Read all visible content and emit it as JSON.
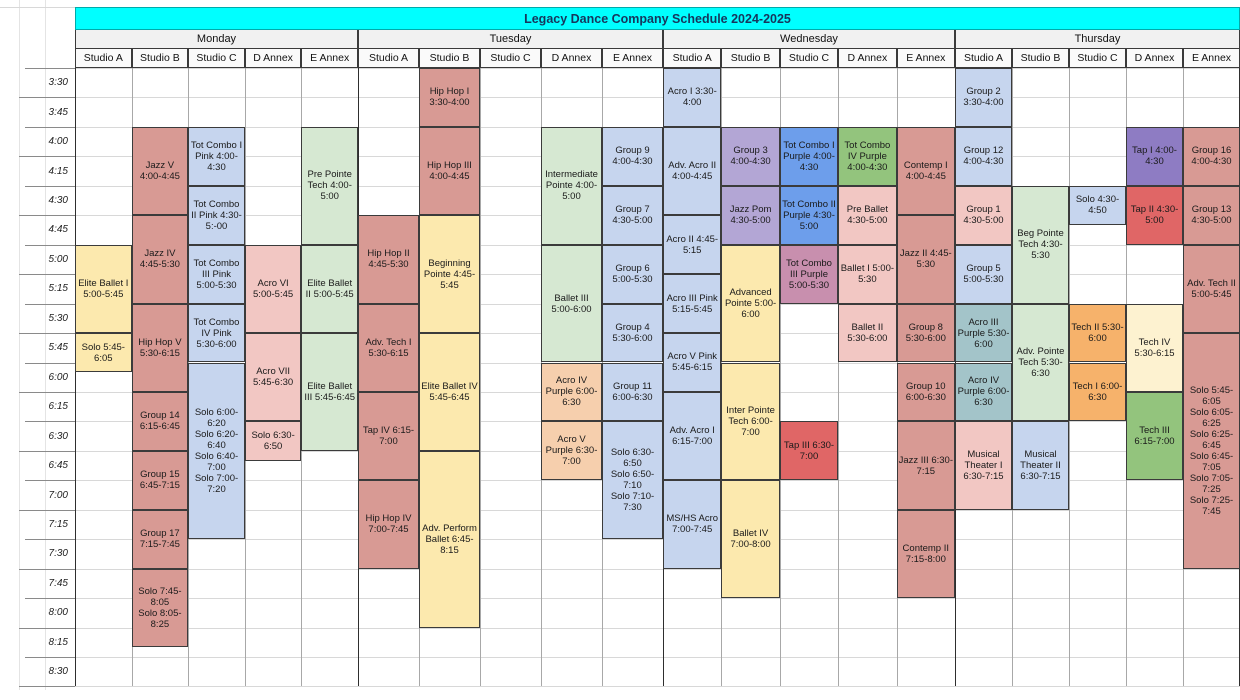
{
  "title": "Legacy Dance Company Schedule 2024-2025",
  "days": [
    {
      "name": "Monday",
      "studios": [
        "Studio A",
        "Studio B",
        "Studio C",
        "D Annex",
        "E Annex"
      ]
    },
    {
      "name": "Tuesday",
      "studios": [
        "Studio A",
        "Studio B",
        "Studio C",
        "D Annex",
        "E Annex"
      ]
    },
    {
      "name": "Wednesday",
      "studios": [
        "Studio A",
        "Studio B",
        "Studio C",
        "D Annex",
        "E Annex"
      ]
    },
    {
      "name": "Thursday",
      "studios": [
        "Studio A",
        "Studio B",
        "Studio C",
        "D Annex",
        "E Annex"
      ]
    }
  ],
  "times": [
    "3:30",
    "3:45",
    "4:00",
    "4:15",
    "4:30",
    "4:45",
    "5:00",
    "5:15",
    "5:30",
    "5:45",
    "6:00",
    "6:15",
    "6:30",
    "6:45",
    "7:00",
    "7:15",
    "7:30",
    "7:45",
    "8:00",
    "8:15",
    "8:30"
  ],
  "colors": {
    "title_bg": "#00ffff",
    "salmon": "#d89a94",
    "pink": "#f2c7c3",
    "periwinkle": "#c6d5ee",
    "yellow": "#fce9ae",
    "cream": "#fdf2d0",
    "green": "#d6e8d2",
    "medgreen": "#93c47d",
    "lavender": "#b3a6d5",
    "purple": "#8e7cc3",
    "red": "#e06666",
    "blue": "#6d9eeb",
    "mauve": "#c88fae",
    "teal": "#a3c4c9",
    "orange": "#f6b26b",
    "peach": "#f6cfad"
  },
  "classes": [
    {
      "day": 0,
      "col": 0,
      "start": "5:00",
      "end": "5:45",
      "color": "yellow",
      "label": "Elite Ballet I 5:00-5:45"
    },
    {
      "day": 0,
      "col": 0,
      "start": "5:45",
      "end": "6:05",
      "color": "yellow",
      "label": "Solo 5:45-6:05"
    },
    {
      "day": 0,
      "col": 1,
      "start": "4:00",
      "end": "4:45",
      "color": "salmon",
      "label": "Jazz V 4:00-4:45"
    },
    {
      "day": 0,
      "col": 1,
      "start": "4:45",
      "end": "5:30",
      "color": "salmon",
      "label": "Jazz IV 4:45-5:30"
    },
    {
      "day": 0,
      "col": 1,
      "start": "5:30",
      "end": "6:15",
      "color": "salmon",
      "label": "Hip Hop V 5:30-6:15"
    },
    {
      "day": 0,
      "col": 1,
      "start": "6:15",
      "end": "6:45",
      "color": "salmon",
      "label": "Group 14 6:15-6:45"
    },
    {
      "day": 0,
      "col": 1,
      "start": "6:45",
      "end": "7:15",
      "color": "salmon",
      "label": "Group 15 6:45-7:15"
    },
    {
      "day": 0,
      "col": 1,
      "start": "7:15",
      "end": "7:45",
      "color": "salmon",
      "label": "Group 17 7:15-7:45"
    },
    {
      "day": 0,
      "col": 1,
      "start": "7:45",
      "end": "8:25",
      "color": "salmon",
      "label": "Solo 7:45-8:05\nSolo 8:05-8:25"
    },
    {
      "day": 0,
      "col": 2,
      "start": "4:00",
      "end": "4:30",
      "color": "periwinkle",
      "label": "Tot Combo I Pink 4:00-4:30"
    },
    {
      "day": 0,
      "col": 2,
      "start": "4:30",
      "end": "5:00",
      "color": "periwinkle",
      "label": "Tot Combo II Pink 4:30-5:-00"
    },
    {
      "day": 0,
      "col": 2,
      "start": "5:00",
      "end": "5:30",
      "color": "periwinkle",
      "label": "Tot Combo III Pink 5:00-5:30"
    },
    {
      "day": 0,
      "col": 2,
      "start": "5:30",
      "end": "6:00",
      "color": "periwinkle",
      "label": "Tot Combo IV Pink 5:30-6:00"
    },
    {
      "day": 0,
      "col": 2,
      "start": "6:00",
      "end": "7:30",
      "color": "periwinkle",
      "label": "Solo 6:00-6:20\nSolo 6:20-6:40\nSolo 6:40-7:00\nSolo 7:00-7:20"
    },
    {
      "day": 0,
      "col": 3,
      "start": "5:00",
      "end": "5:45",
      "color": "pink",
      "label": "Acro VI 5:00-5:45"
    },
    {
      "day": 0,
      "col": 3,
      "start": "5:45",
      "end": "6:30",
      "color": "pink",
      "label": "Acro VII 5:45-6:30"
    },
    {
      "day": 0,
      "col": 3,
      "start": "6:30",
      "end": "6:50",
      "color": "pink",
      "label": "Solo 6:30-6:50"
    },
    {
      "day": 0,
      "col": 4,
      "start": "4:00",
      "end": "5:00",
      "color": "green",
      "label": "Pre Pointe Tech 4:00-5:00"
    },
    {
      "day": 0,
      "col": 4,
      "start": "5:00",
      "end": "5:45",
      "color": "green",
      "label": "Elite Ballet II 5:00-5:45"
    },
    {
      "day": 0,
      "col": 4,
      "start": "5:45",
      "end": "6:45",
      "color": "green",
      "label": "Elite Ballet III 5:45-6:45"
    },
    {
      "day": 1,
      "col": 0,
      "start": "4:45",
      "end": "5:30",
      "color": "salmon",
      "label": "Hip Hop II 4:45-5:30"
    },
    {
      "day": 1,
      "col": 0,
      "start": "5:30",
      "end": "6:15",
      "color": "salmon",
      "label": "Adv. Tech I 5:30-6:15"
    },
    {
      "day": 1,
      "col": 0,
      "start": "6:15",
      "end": "7:00",
      "color": "salmon",
      "label": "Tap IV 6:15-7:00"
    },
    {
      "day": 1,
      "col": 0,
      "start": "7:00",
      "end": "7:45",
      "color": "salmon",
      "label": "Hip Hop IV 7:00-7:45"
    },
    {
      "day": 1,
      "col": 1,
      "start": "3:30",
      "end": "4:00",
      "color": "salmon",
      "label": "Hip Hop I 3:30-4:00"
    },
    {
      "day": 1,
      "col": 1,
      "start": "4:00",
      "end": "4:45",
      "color": "salmon",
      "label": "Hip Hop III 4:00-4:45"
    },
    {
      "day": 1,
      "col": 1,
      "start": "4:45",
      "end": "5:45",
      "color": "yellow",
      "label": "Beginning Pointe 4:45-5:45"
    },
    {
      "day": 1,
      "col": 1,
      "start": "5:45",
      "end": "6:45",
      "color": "yellow",
      "label": "Elite Ballet IV 5:45-6:45"
    },
    {
      "day": 1,
      "col": 1,
      "start": "6:45",
      "end": "8:15",
      "color": "yellow",
      "label": "Adv. Perform Ballet 6:45-8:15"
    },
    {
      "day": 1,
      "col": 3,
      "start": "4:00",
      "end": "5:00",
      "color": "green",
      "label": "Intermediate Pointe 4:00-5:00"
    },
    {
      "day": 1,
      "col": 3,
      "start": "5:00",
      "end": "6:00",
      "color": "green",
      "label": "Ballet III 5:00-6:00"
    },
    {
      "day": 1,
      "col": 3,
      "start": "6:00",
      "end": "6:30",
      "color": "peach",
      "label": "Acro IV Purple 6:00-6:30"
    },
    {
      "day": 1,
      "col": 3,
      "start": "6:30",
      "end": "7:00",
      "color": "peach",
      "label": "Acro V Purple 6:30-7:00"
    },
    {
      "day": 1,
      "col": 4,
      "start": "4:00",
      "end": "4:30",
      "color": "periwinkle",
      "label": "Group 9 4:00-4:30"
    },
    {
      "day": 1,
      "col": 4,
      "start": "4:30",
      "end": "5:00",
      "color": "periwinkle",
      "label": "Group 7 4:30-5:00"
    },
    {
      "day": 1,
      "col": 4,
      "start": "5:00",
      "end": "5:30",
      "color": "periwinkle",
      "label": "Group 6 5:00-5:30"
    },
    {
      "day": 1,
      "col": 4,
      "start": "5:30",
      "end": "6:00",
      "color": "periwinkle",
      "label": "Group 4 5:30-6:00"
    },
    {
      "day": 1,
      "col": 4,
      "start": "6:00",
      "end": "6:30",
      "color": "periwinkle",
      "label": "Group 11 6:00-6:30"
    },
    {
      "day": 1,
      "col": 4,
      "start": "6:30",
      "end": "7:30",
      "color": "periwinkle",
      "label": "Solo 6:30-6:50\nSolo 6:50-7:10\nSolo 7:10-7:30"
    },
    {
      "day": 2,
      "col": 0,
      "start": "3:30",
      "end": "4:00",
      "color": "periwinkle",
      "label": "Acro I 3:30-4:00"
    },
    {
      "day": 2,
      "col": 0,
      "start": "4:00",
      "end": "4:45",
      "color": "periwinkle",
      "label": "Adv. Acro II 4:00-4:45"
    },
    {
      "day": 2,
      "col": 0,
      "start": "4:45",
      "end": "5:15",
      "color": "periwinkle",
      "label": "Acro II 4:45-5:15"
    },
    {
      "day": 2,
      "col": 0,
      "start": "5:15",
      "end": "5:45",
      "color": "periwinkle",
      "label": "Acro III Pink 5:15-5:45"
    },
    {
      "day": 2,
      "col": 0,
      "start": "5:45",
      "end": "6:15",
      "color": "periwinkle",
      "label": "Acro V Pink 5:45-6:15"
    },
    {
      "day": 2,
      "col": 0,
      "start": "6:15",
      "end": "7:00",
      "color": "periwinkle",
      "label": "Adv. Acro I 6:15-7:00"
    },
    {
      "day": 2,
      "col": 0,
      "start": "7:00",
      "end": "7:45",
      "color": "periwinkle",
      "label": "MS/HS Acro 7:00-7:45"
    },
    {
      "day": 2,
      "col": 1,
      "start": "4:00",
      "end": "4:30",
      "color": "lavender",
      "label": "Group 3 4:00-4:30"
    },
    {
      "day": 2,
      "col": 1,
      "start": "4:30",
      "end": "5:00",
      "color": "lavender",
      "label": "Jazz Pom 4:30-5:00"
    },
    {
      "day": 2,
      "col": 1,
      "start": "5:00",
      "end": "6:00",
      "color": "yellow",
      "label": "Advanced Pointe 5:00-6:00"
    },
    {
      "day": 2,
      "col": 1,
      "start": "6:00",
      "end": "7:00",
      "color": "yellow",
      "label": "Inter Pointe Tech 6:00-7:00"
    },
    {
      "day": 2,
      "col": 1,
      "start": "7:00",
      "end": "8:00",
      "color": "yellow",
      "label": "Ballet IV 7:00-8:00"
    },
    {
      "day": 2,
      "col": 2,
      "start": "4:00",
      "end": "4:30",
      "color": "blue",
      "label": "Tot Combo I Purple 4:00-4:30"
    },
    {
      "day": 2,
      "col": 2,
      "start": "4:30",
      "end": "5:00",
      "color": "blue",
      "label": "Tot Combo II Purple 4:30-5:00"
    },
    {
      "day": 2,
      "col": 2,
      "start": "5:00",
      "end": "5:30",
      "color": "mauve",
      "label": "Tot Combo III Purple 5:00-5:30"
    },
    {
      "day": 2,
      "col": 2,
      "start": "6:30",
      "end": "7:00",
      "color": "red",
      "label": "Tap III 6:30-7:00"
    },
    {
      "day": 2,
      "col": 3,
      "start": "4:00",
      "end": "4:30",
      "color": "medgreen",
      "label": "Tot Combo IV Purple 4:00-4:30"
    },
    {
      "day": 2,
      "col": 3,
      "start": "4:30",
      "end": "5:00",
      "color": "pink",
      "label": "Pre Ballet 4:30-5:00"
    },
    {
      "day": 2,
      "col": 3,
      "start": "5:00",
      "end": "5:30",
      "color": "pink",
      "label": "Ballet I 5:00-5:30"
    },
    {
      "day": 2,
      "col": 3,
      "start": "5:30",
      "end": "6:00",
      "color": "pink",
      "label": "Ballet II 5:30-6:00"
    },
    {
      "day": 2,
      "col": 4,
      "start": "4:00",
      "end": "4:45",
      "color": "salmon",
      "label": "Contemp I 4:00-4:45"
    },
    {
      "day": 2,
      "col": 4,
      "start": "4:45",
      "end": "5:30",
      "color": "salmon",
      "label": "Jazz II 4:45-5:30"
    },
    {
      "day": 2,
      "col": 4,
      "start": "5:30",
      "end": "6:00",
      "color": "salmon",
      "label": "Group 8 5:30-6:00"
    },
    {
      "day": 2,
      "col": 4,
      "start": "6:00",
      "end": "6:30",
      "color": "salmon",
      "label": "Group 10 6:00-6:30"
    },
    {
      "day": 2,
      "col": 4,
      "start": "6:30",
      "end": "7:15",
      "color": "salmon",
      "label": "Jazz III 6:30-7:15"
    },
    {
      "day": 2,
      "col": 4,
      "start": "7:15",
      "end": "8:00",
      "color": "salmon",
      "label": "Contemp II 7:15-8:00"
    },
    {
      "day": 3,
      "col": 0,
      "start": "3:30",
      "end": "4:00",
      "color": "periwinkle",
      "label": "Group 2 3:30-4:00"
    },
    {
      "day": 3,
      "col": 0,
      "start": "4:00",
      "end": "4:30",
      "color": "periwinkle",
      "label": "Group 12 4:00-4:30"
    },
    {
      "day": 3,
      "col": 0,
      "start": "4:30",
      "end": "5:00",
      "color": "pink",
      "label": "Group 1 4:30-5:00"
    },
    {
      "day": 3,
      "col": 0,
      "start": "5:00",
      "end": "5:30",
      "color": "periwinkle",
      "label": "Group 5 5:00-5:30"
    },
    {
      "day": 3,
      "col": 0,
      "start": "5:30",
      "end": "6:00",
      "color": "teal",
      "label": "Acro III Purple 5:30-6:00"
    },
    {
      "day": 3,
      "col": 0,
      "start": "6:00",
      "end": "6:30",
      "color": "teal",
      "label": "Acro IV Purple 6:00-6:30"
    },
    {
      "day": 3,
      "col": 0,
      "start": "6:30",
      "end": "7:15",
      "color": "pink",
      "label": "Musical Theater I 6:30-7:15"
    },
    {
      "day": 3,
      "col": 1,
      "start": "4:30",
      "end": "5:30",
      "color": "green",
      "label": "Beg Pointe Tech 4:30-5:30"
    },
    {
      "day": 3,
      "col": 1,
      "start": "5:30",
      "end": "6:30",
      "color": "green",
      "label": "Adv. Pointe Tech 5:30-6:30"
    },
    {
      "day": 3,
      "col": 1,
      "start": "6:30",
      "end": "7:15",
      "color": "periwinkle",
      "label": "Musical Theater II 6:30-7:15"
    },
    {
      "day": 3,
      "col": 2,
      "start": "4:30",
      "end": "4:50",
      "color": "periwinkle",
      "label": "Solo 4:30-4:50"
    },
    {
      "day": 3,
      "col": 2,
      "start": "5:30",
      "end": "6:00",
      "color": "orange",
      "label": "Tech II 5:30-6:00"
    },
    {
      "day": 3,
      "col": 2,
      "start": "6:00",
      "end": "6:30",
      "color": "orange",
      "label": "Tech I 6:00-6:30"
    },
    {
      "day": 3,
      "col": 3,
      "start": "4:00",
      "end": "4:30",
      "color": "purple",
      "label": "Tap I 4:00-4:30"
    },
    {
      "day": 3,
      "col": 3,
      "start": "4:30",
      "end": "5:00",
      "color": "red",
      "label": "Tap II 4:30-5:00"
    },
    {
      "day": 3,
      "col": 3,
      "start": "5:30",
      "end": "6:15",
      "color": "cream",
      "label": "Tech IV 5:30-6:15"
    },
    {
      "day": 3,
      "col": 3,
      "start": "6:15",
      "end": "7:00",
      "color": "medgreen",
      "label": "Tech III 6:15-7:00"
    },
    {
      "day": 3,
      "col": 4,
      "start": "4:00",
      "end": "4:30",
      "color": "salmon",
      "label": "Group 16 4:00-4:30"
    },
    {
      "day": 3,
      "col": 4,
      "start": "4:30",
      "end": "5:00",
      "color": "salmon",
      "label": "Group 13 4:30-5:00"
    },
    {
      "day": 3,
      "col": 4,
      "start": "5:00",
      "end": "5:45",
      "color": "salmon",
      "label": "Adv. Tech II 5:00-5:45"
    },
    {
      "day": 3,
      "col": 4,
      "start": "5:45",
      "end": "7:45",
      "color": "salmon",
      "label": "Solo 5:45-6:05\nSolo 6:05-6:25\nSolo 6:25-6:45\nSolo 6:45-7:05\nSolo 7:05-7:25\nSolo 7:25-7:45"
    }
  ]
}
